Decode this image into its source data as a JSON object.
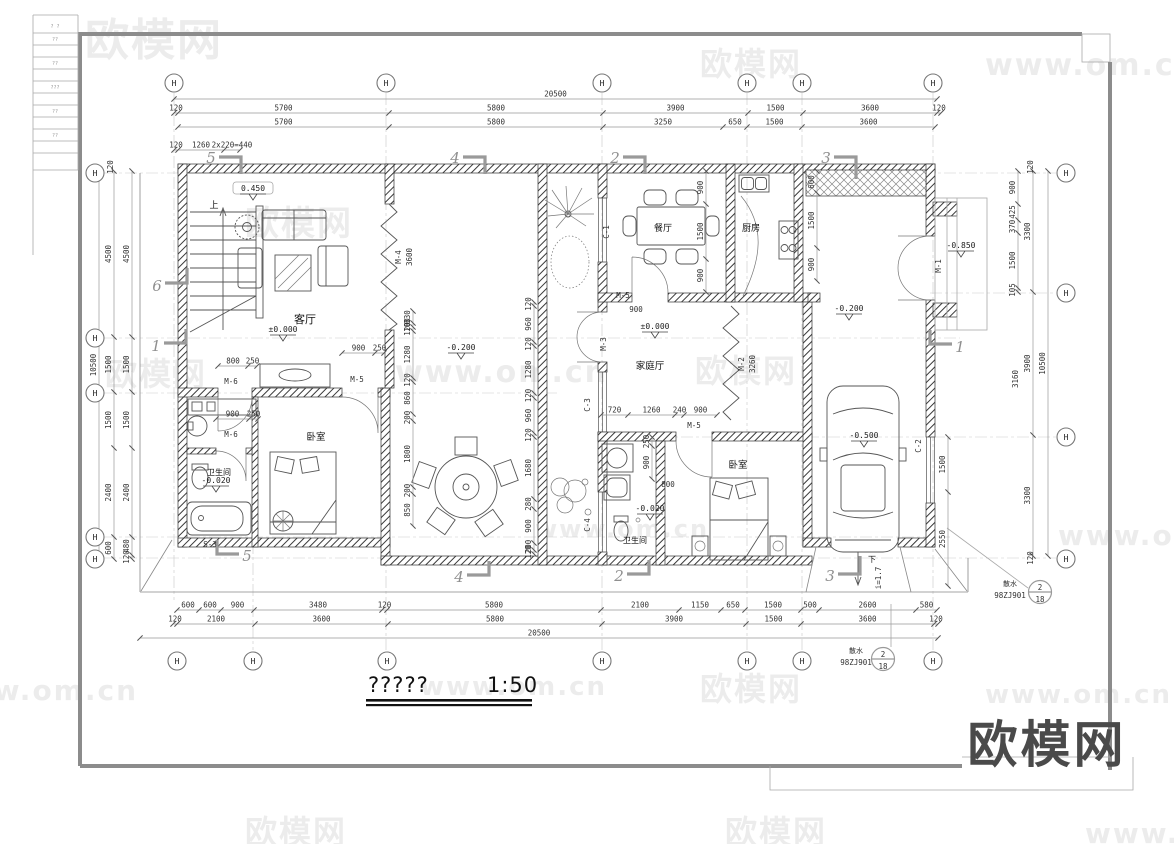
{
  "watermark": {
    "brand": "欧模网",
    "site": "www.om.cn"
  },
  "logo_text": "欧模网",
  "plan_title": {
    "name": "?????",
    "scale": "1:50"
  },
  "title_block_rows": [
    "?  ?",
    "??",
    "",
    "??",
    "",
    "???",
    "",
    "??",
    "",
    "??",
    "",
    ""
  ],
  "axis": {
    "label": "H"
  },
  "rooms": {
    "living": "客厅",
    "dining": "餐厅",
    "kitchen": "厨房",
    "family": "家庭厅",
    "bedroom_left": "卧室",
    "bedroom_right": "卧室",
    "bath_left": "卫生间",
    "bath_mid": "卫生间"
  },
  "levels": {
    "stair": "0.450",
    "living": "±0.000",
    "family": "±0.000",
    "courtyard": "-0.200",
    "terrace": "-0.200",
    "porch": "-0.850",
    "garage": "-0.500",
    "bath_left": "-0.020",
    "bath_mid": "-0.020"
  },
  "stair": {
    "up": "上",
    "tag": "S-3"
  },
  "ramp": {
    "down": "下",
    "slope": "i=1.7"
  },
  "doors": {
    "m1": "M-1",
    "m2": "M-2",
    "m3": "M-3",
    "m4": "M-4",
    "m5": "M-5",
    "m6": "M-6"
  },
  "windows": {
    "c1": "C-1",
    "c2": "C-2",
    "c3": "C-3",
    "c4": "C-4"
  },
  "sections": {
    "s1": "1",
    "s2": "2",
    "s3": "3",
    "s4": "4",
    "s5": "5",
    "s6": "6"
  },
  "detail": {
    "num": "2",
    "page": "18",
    "note": "散水",
    "code": "98ZJ901"
  },
  "dims": {
    "top_total": [
      "20500"
    ],
    "top_row2": [
      "120",
      "5700",
      "5800",
      "3900",
      "1500",
      "3600",
      "120"
    ],
    "top_row3": [
      "5700",
      "5800",
      "3250",
      "650",
      "1500",
      "3600"
    ],
    "top_stair": [
      "120",
      "1260",
      "2x220=440"
    ],
    "bottom_row1": [
      "600",
      "600",
      "900",
      "3480",
      "120",
      "5800",
      "2100",
      "1150",
      "650",
      "1500",
      "500",
      "2600",
      "580"
    ],
    "bottom_row2": [
      "120",
      "2100",
      "3600",
      "5800",
      "3900",
      "1500",
      "3600",
      "120"
    ],
    "bottom_total": [
      "20500"
    ],
    "left_total": [
      "10500"
    ],
    "left_outer": [
      "4500",
      "1500",
      "1500",
      "2400",
      "600"
    ],
    "left_inner": [
      "4500",
      "1500",
      "1500",
      "2400",
      "480",
      "120"
    ],
    "left_wall": "120",
    "right_total": [
      "10500"
    ],
    "right_col": [
      "3300",
      "3900",
      "3300"
    ],
    "right_upper": [
      "900",
      "425",
      "370",
      "1500",
      "105"
    ],
    "right_mid": "3160",
    "right_wall_top": "120",
    "right_wall_bottom": "120",
    "right_garage": [
      "1500",
      "2550"
    ],
    "center_chain": [
      "120",
      "960",
      "120",
      "1280",
      "120",
      "960",
      "120",
      "1680",
      "280",
      "900",
      "200",
      "120"
    ],
    "court_chain": [
      "330",
      "100",
      "120",
      "1280",
      "120",
      "860",
      "200",
      "1800",
      "200",
      "850"
    ],
    "dining_chain": [
      "900",
      "1500",
      "900"
    ],
    "kitchen_chain": [
      "600",
      "1500",
      "900"
    ],
    "family_row": [
      "720",
      "1260",
      "240",
      "900"
    ],
    "bath_chain": [
      "250",
      "900"
    ],
    "bath_w": "800",
    "door_m5_living": [
      "900",
      "250"
    ],
    "door_m6_upper": [
      "800",
      "250"
    ],
    "door_m6_lower": [
      "900",
      "250"
    ],
    "door_m5_dining": "900",
    "m4_len": "3600",
    "m2_len": "3260"
  }
}
